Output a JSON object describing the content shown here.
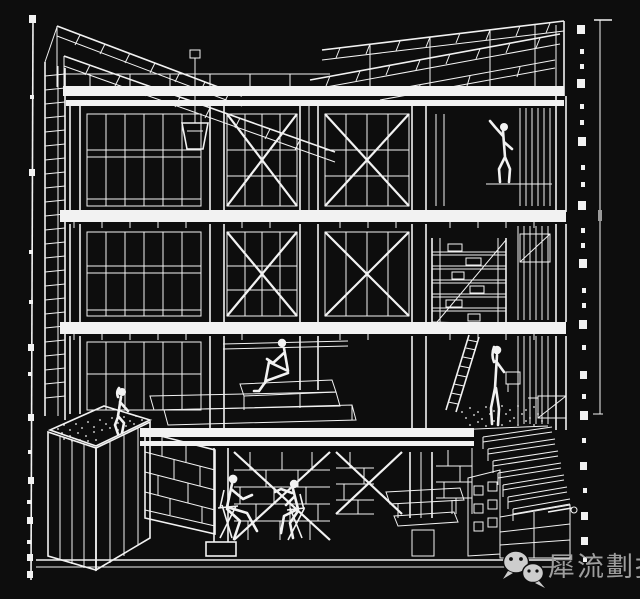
{
  "canvas": {
    "width": 640,
    "height": 599,
    "background": "#0d0d0d",
    "line_color": "#f2f2f2",
    "watermark_icon_color": "#cdcdcd",
    "watermark_text_color": "#9e9e9e"
  },
  "drawing": {
    "type": "architectural-sectional-perspective",
    "style": "white wireframe linework on black",
    "elements": [
      "sloped roof with ladder-truss rafters",
      "three floor levels with X-braced timber frame",
      "mullioned window walls",
      "hanging pendant lamp",
      "storage shelf tower",
      "leaning ladder",
      "stepped timber platform",
      "planter box with gravel stipple",
      "masonry basement walls",
      "descending staircase with handrail",
      "survey datum lines with square tick markers"
    ],
    "figures": [
      "worker reaching up on top-floor scaffold",
      "person sitting on mezzanine platform with knee raised",
      "person sitting on planter edge",
      "two people seated on chairs facing each other in basement",
      "person standing at stair landing"
    ]
  },
  "watermark": {
    "text": "犀流劃报",
    "icons": [
      {
        "name": "wechat-bubble-large"
      },
      {
        "name": "wechat-bubble-small"
      }
    ]
  }
}
